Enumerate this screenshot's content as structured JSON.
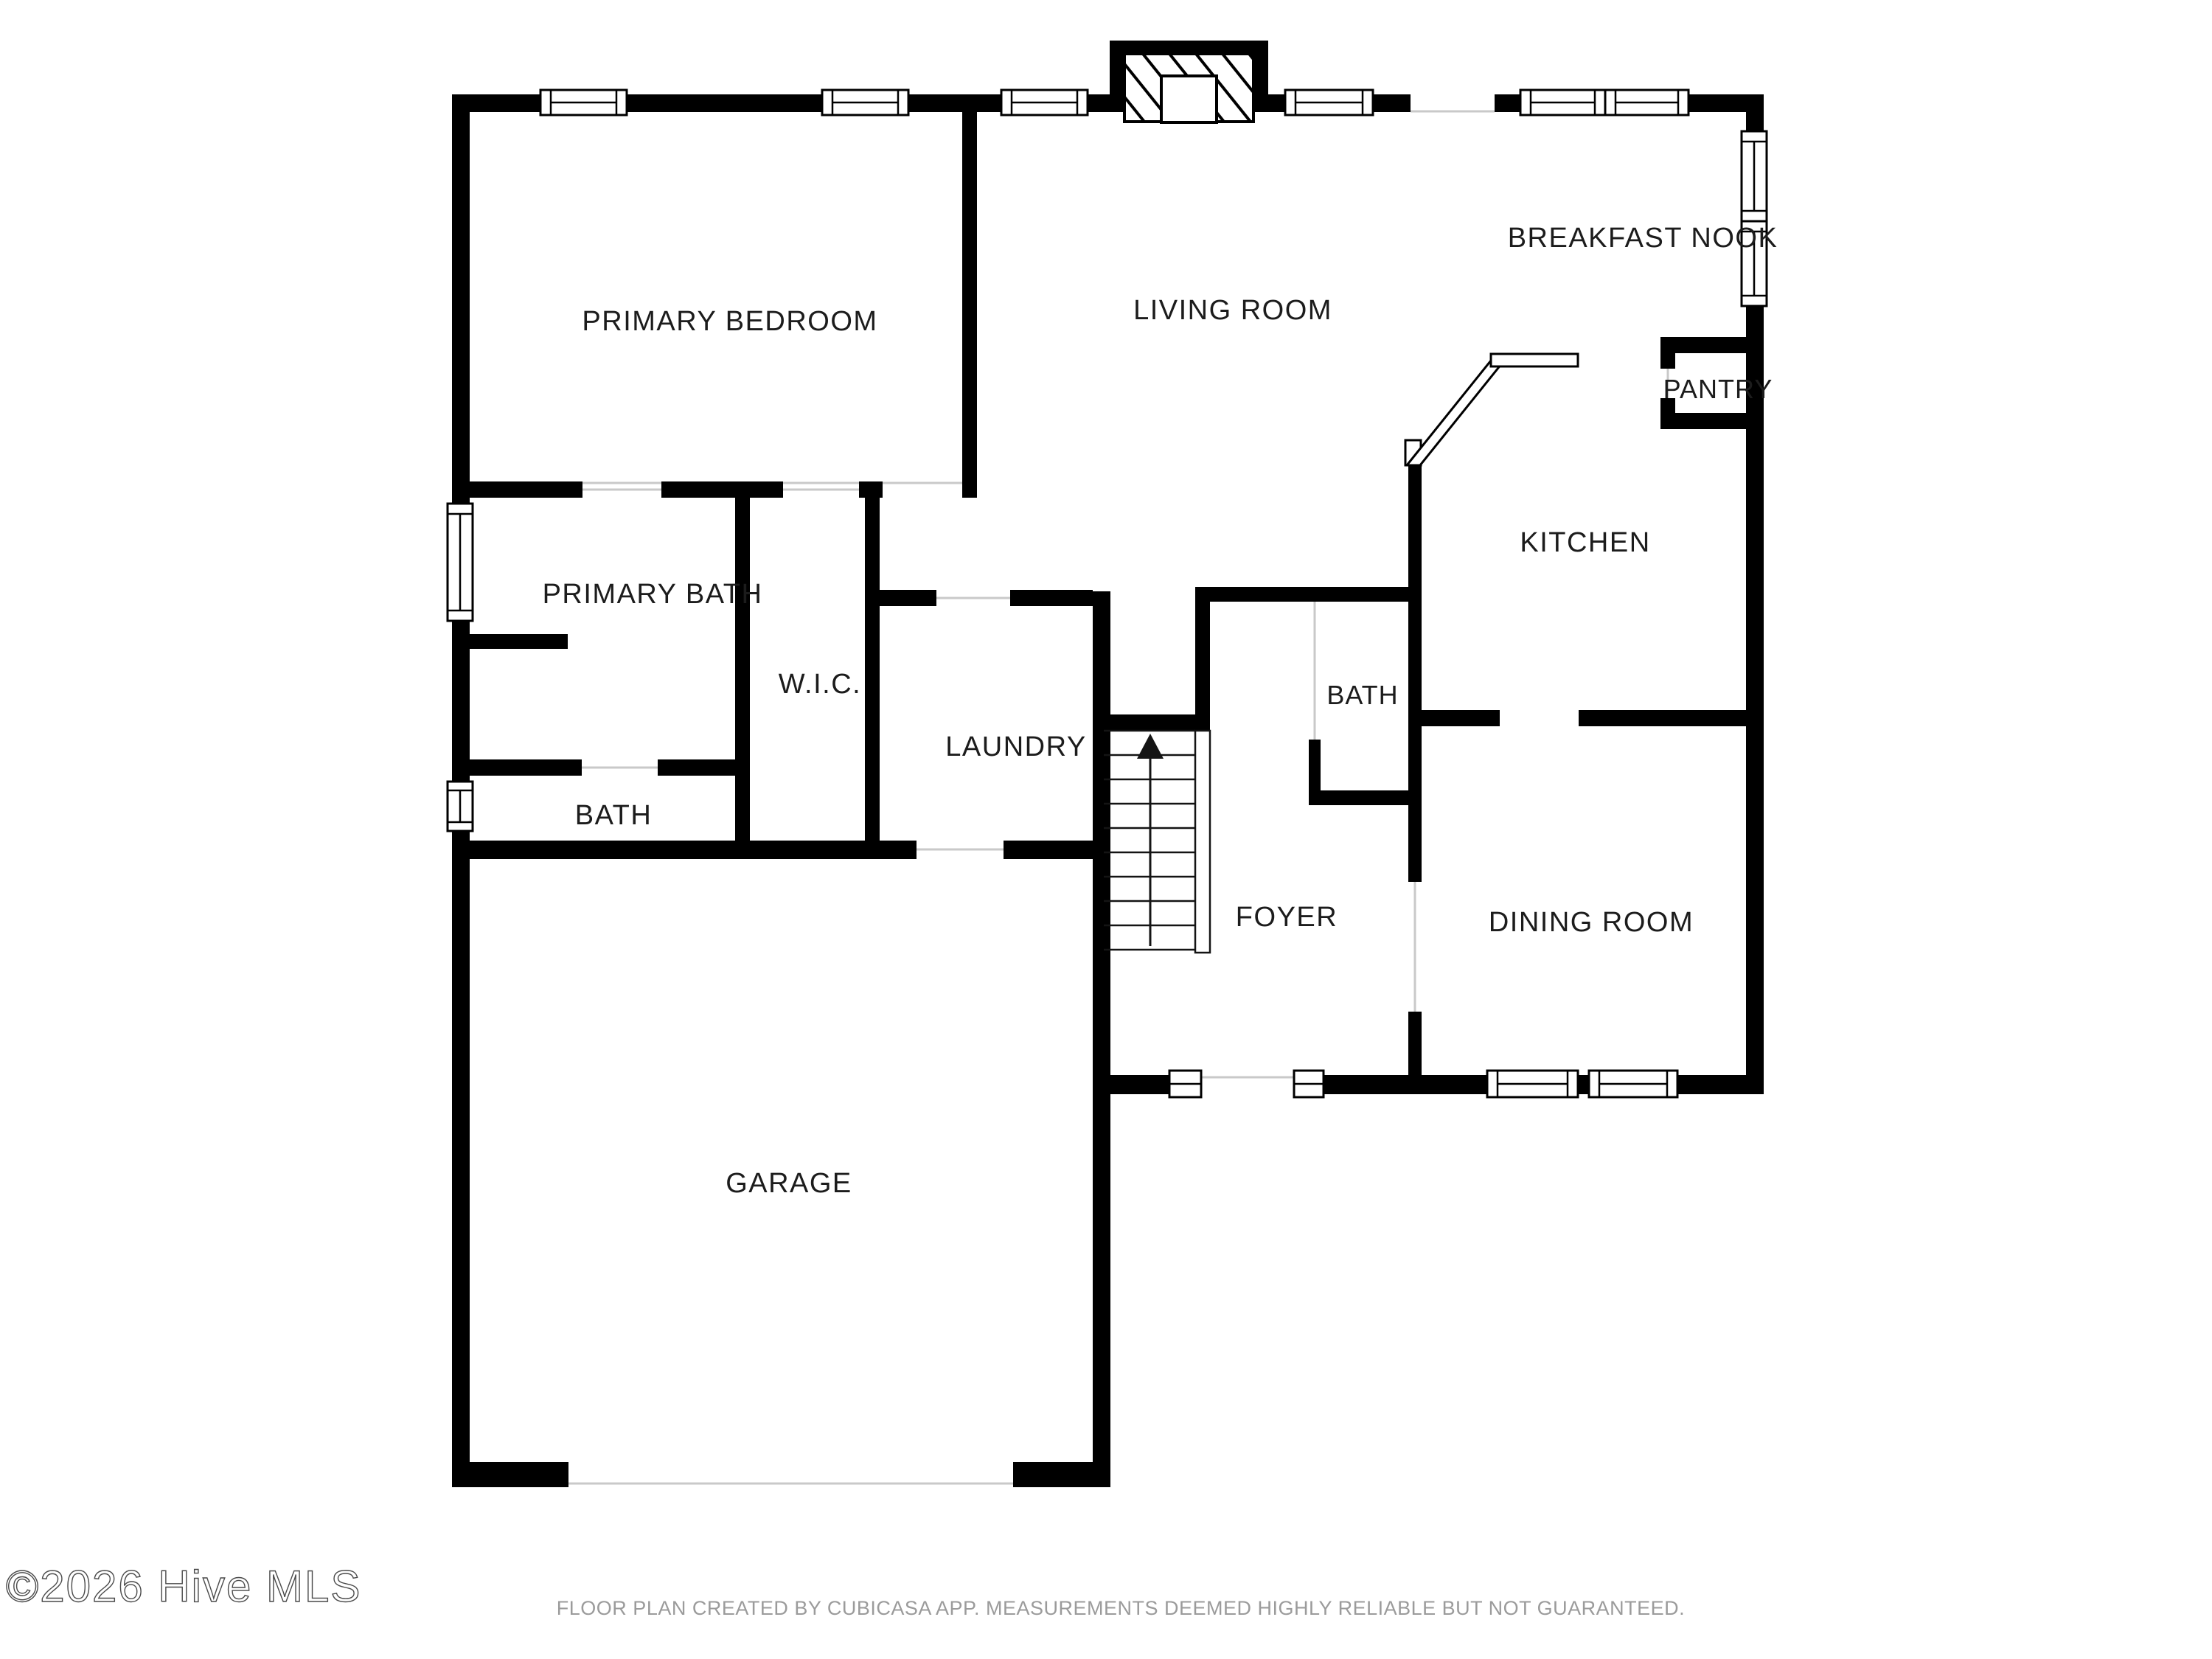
{
  "rooms": {
    "primary_bedroom": "PRIMARY BEDROOM",
    "living_room": "LIVING ROOM",
    "breakfast_nook": "BREAKFAST NOOK",
    "pantry": "PANTRY",
    "kitchen": "KITCHEN",
    "primary_bath": "PRIMARY BATH",
    "wic": "W.I.C.",
    "laundry": "LAUNDRY",
    "bath": "BATH",
    "half_bath": "BATH",
    "foyer": "FOYER",
    "dining_room": "DINING ROOM",
    "garage": "GARAGE"
  },
  "footer": {
    "watermark": "©2026 Hive MLS",
    "disclaimer": "FLOOR PLAN CREATED BY CUBICASA APP. MEASUREMENTS DEEMED HIGHLY RELIABLE BUT NOT GUARANTEED."
  },
  "icons": {
    "stairs_direction": "arrow-up"
  },
  "colors": {
    "wall": "#000000",
    "background": "#ffffff",
    "label_text": "#1c1c1c",
    "muted_text": "#9b9b9b",
    "opening_line": "#c9c9c9"
  }
}
